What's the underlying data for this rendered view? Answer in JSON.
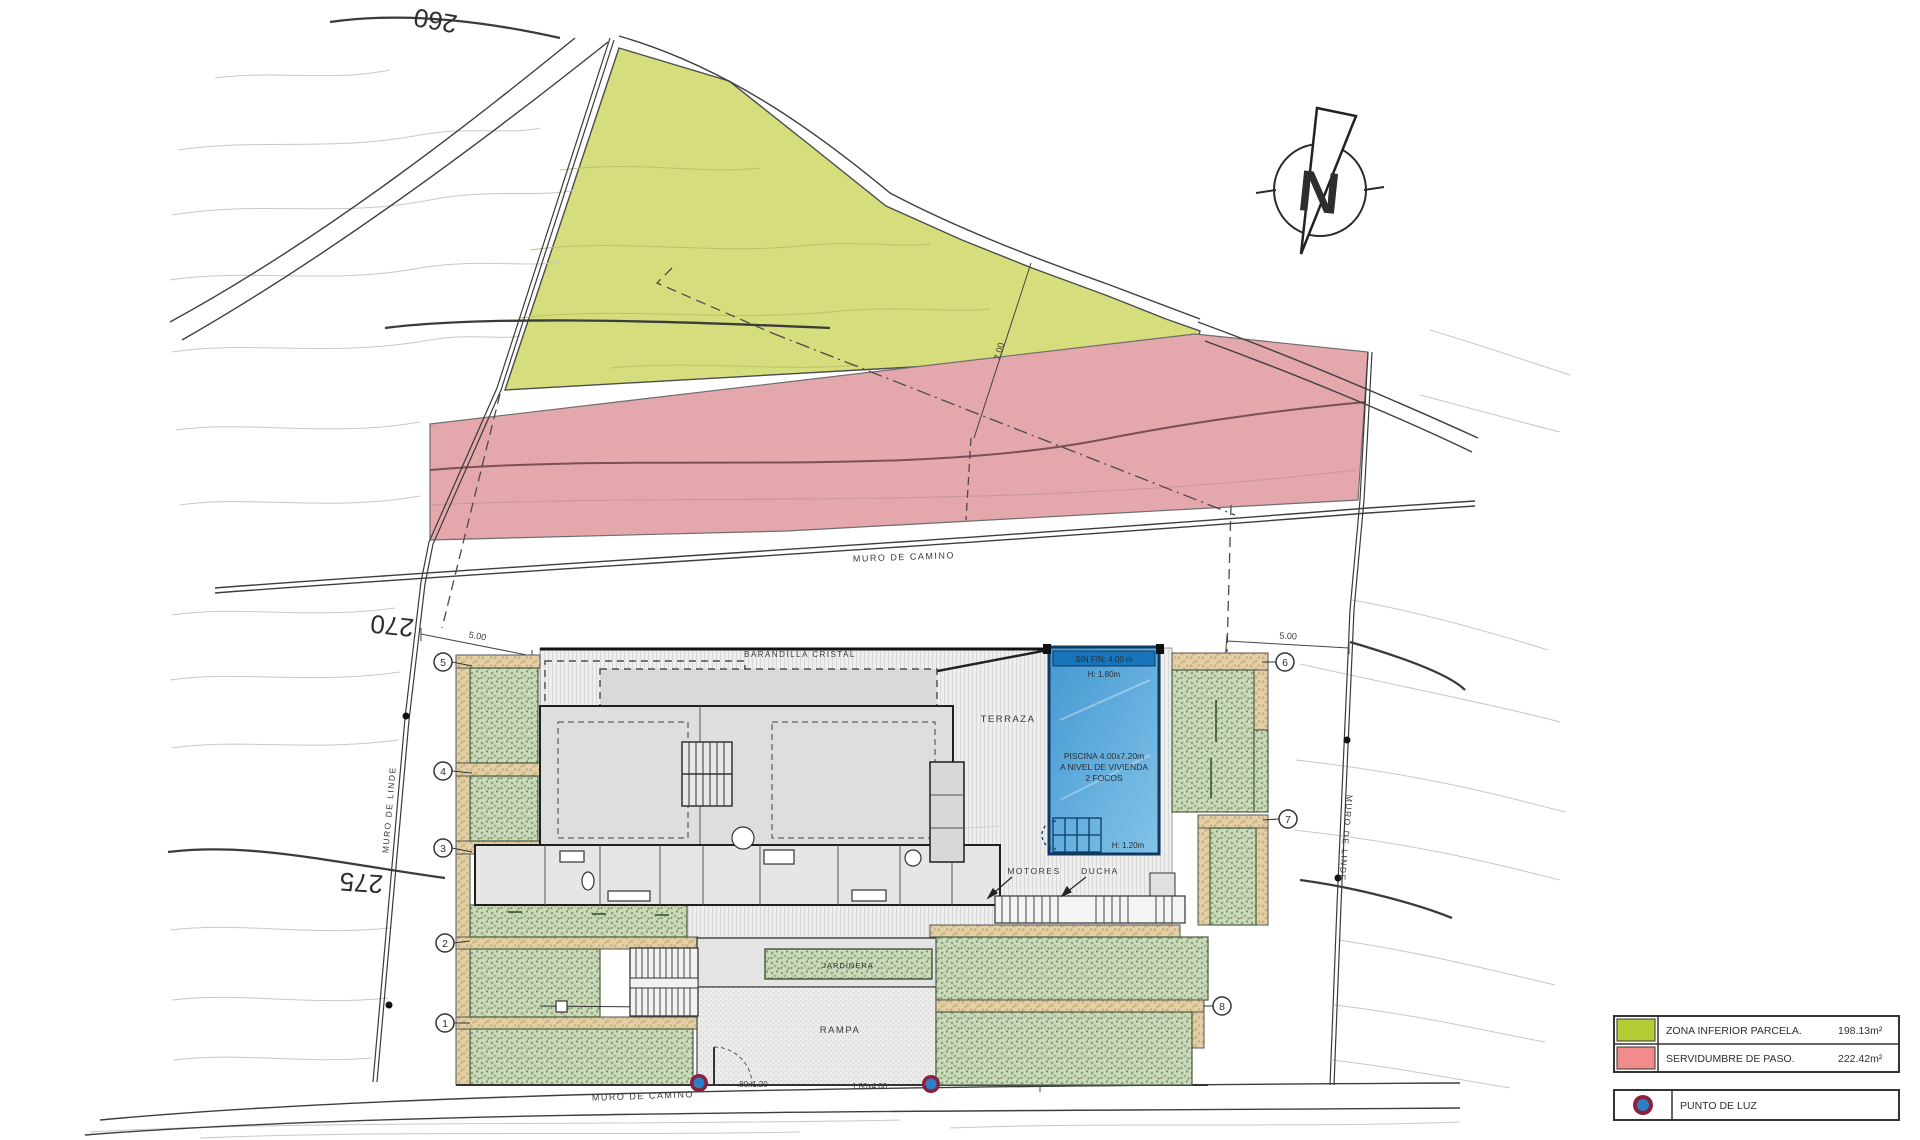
{
  "site_plan": {
    "contour_labels": {
      "c260": "260",
      "c270": "270",
      "c275": "275"
    },
    "walls": {
      "muro_camino_top": "MURO DE CAMINO",
      "muro_camino_bottom": "MURO DE CAMINO",
      "muro_linde_left": "MURO DE LINDE",
      "muro_linde_right": "MURO DE LINDE"
    },
    "dimensions": {
      "left_setback": "5.00",
      "right_setback": "5.00",
      "green_depth": "7.00",
      "garden_width": "7.48",
      "door": ".80x1.20",
      "gate": "1.80x4.00"
    },
    "labels": {
      "barandilla": "BARANDILLA CRISTAL",
      "terraza": "TERRAZA",
      "rampa": "RAMPA",
      "jardinera": "JARDINERA",
      "motores": "MOTORES",
      "ducha": "DUCHA"
    },
    "pool": {
      "sinfin": "SIN FIN: 4.00 m",
      "h_top": "H: 1.80m",
      "line1": "PISCINA 4.00x7.20m",
      "line2": "A NIVEL DE VIVIENDA",
      "line3": "2 FOCOS",
      "h_bottom": "H: 1.20m"
    },
    "markers": {
      "m1": "1",
      "m2": "2",
      "m3": "3",
      "m4": "4",
      "m5": "5",
      "m6": "6",
      "m7": "7",
      "m8": "8"
    },
    "compass": {
      "letter": "N"
    }
  },
  "legend": {
    "zona_label": "ZONA INFERIOR PARCELA.",
    "zona_value": "198.13m²",
    "zona_color": "#b5cc34",
    "servidumbre_label": "SERVIDUMBRE DE PASO.",
    "servidumbre_value": "222.42m²",
    "servidumbre_color": "#f28b8b",
    "punto_label": "PUNTO DE LUZ"
  },
  "colors": {
    "zona_fill": "#d5dd7c",
    "servidumbre_fill": "#e3a7ac",
    "pool_blue": "#4498d2",
    "light_ring": "#8a2040",
    "light_dot": "#2d7fc6"
  }
}
